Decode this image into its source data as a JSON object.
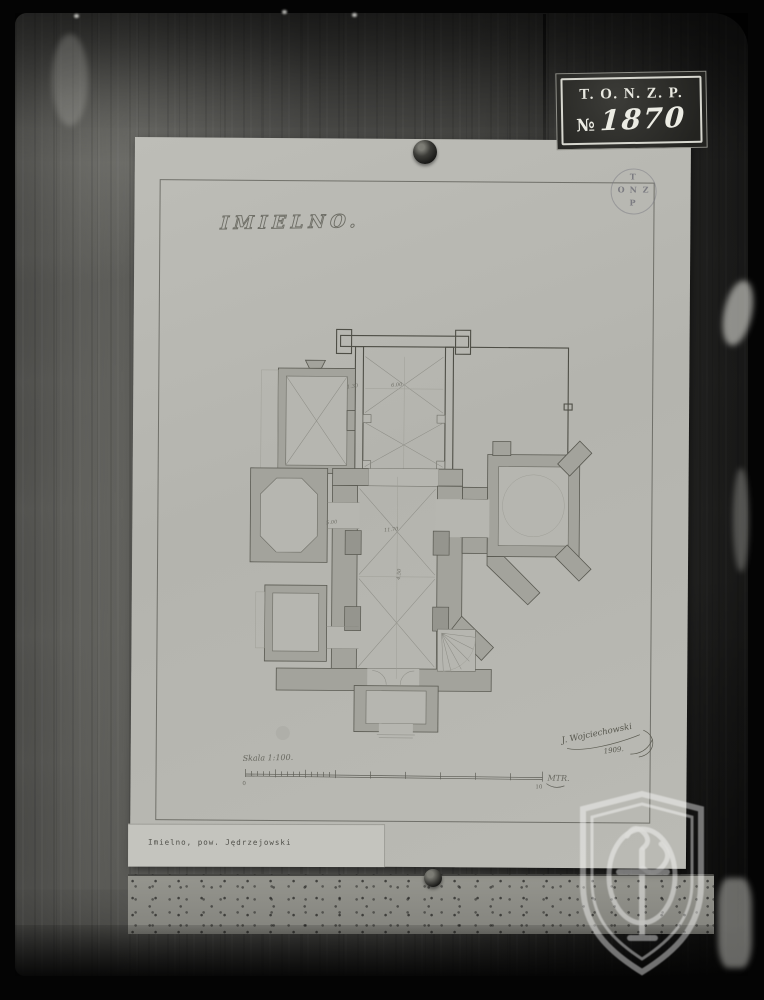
{
  "label_plate": {
    "line1": "T. O. N. Z. P.",
    "numero_sign": "№",
    "number": "1870"
  },
  "sheet": {
    "title": "IMIELNO.",
    "stamp": {
      "top": "T",
      "left": "O",
      "center": "N",
      "right": "Z",
      "bottom": "P"
    },
    "plan_annotations": {
      "a1": "1.30",
      "a2": "6.00",
      "a3": "5.00",
      "a4": "11.70",
      "a5": "4.50"
    },
    "scale_bar": {
      "label": "Skala 1:100.",
      "unit": "MTR.",
      "tick_start": "0",
      "tick_end": "10"
    },
    "signature": {
      "name": "J. Wojciechowski",
      "year": "1909."
    },
    "caption": "Imielno, pow. Jędrzejowski"
  },
  "colors": {
    "paper": "#b7b7b1",
    "wood": "#4f4f4c",
    "plan_wall": "#a3a39c",
    "ink": "#4e4e46",
    "plate_bg": "#2b2b28",
    "plate_border": "#d7d7cf",
    "plate_text": "#e9e9e1",
    "watermark": "rgba(255,255,255,0.5)"
  }
}
